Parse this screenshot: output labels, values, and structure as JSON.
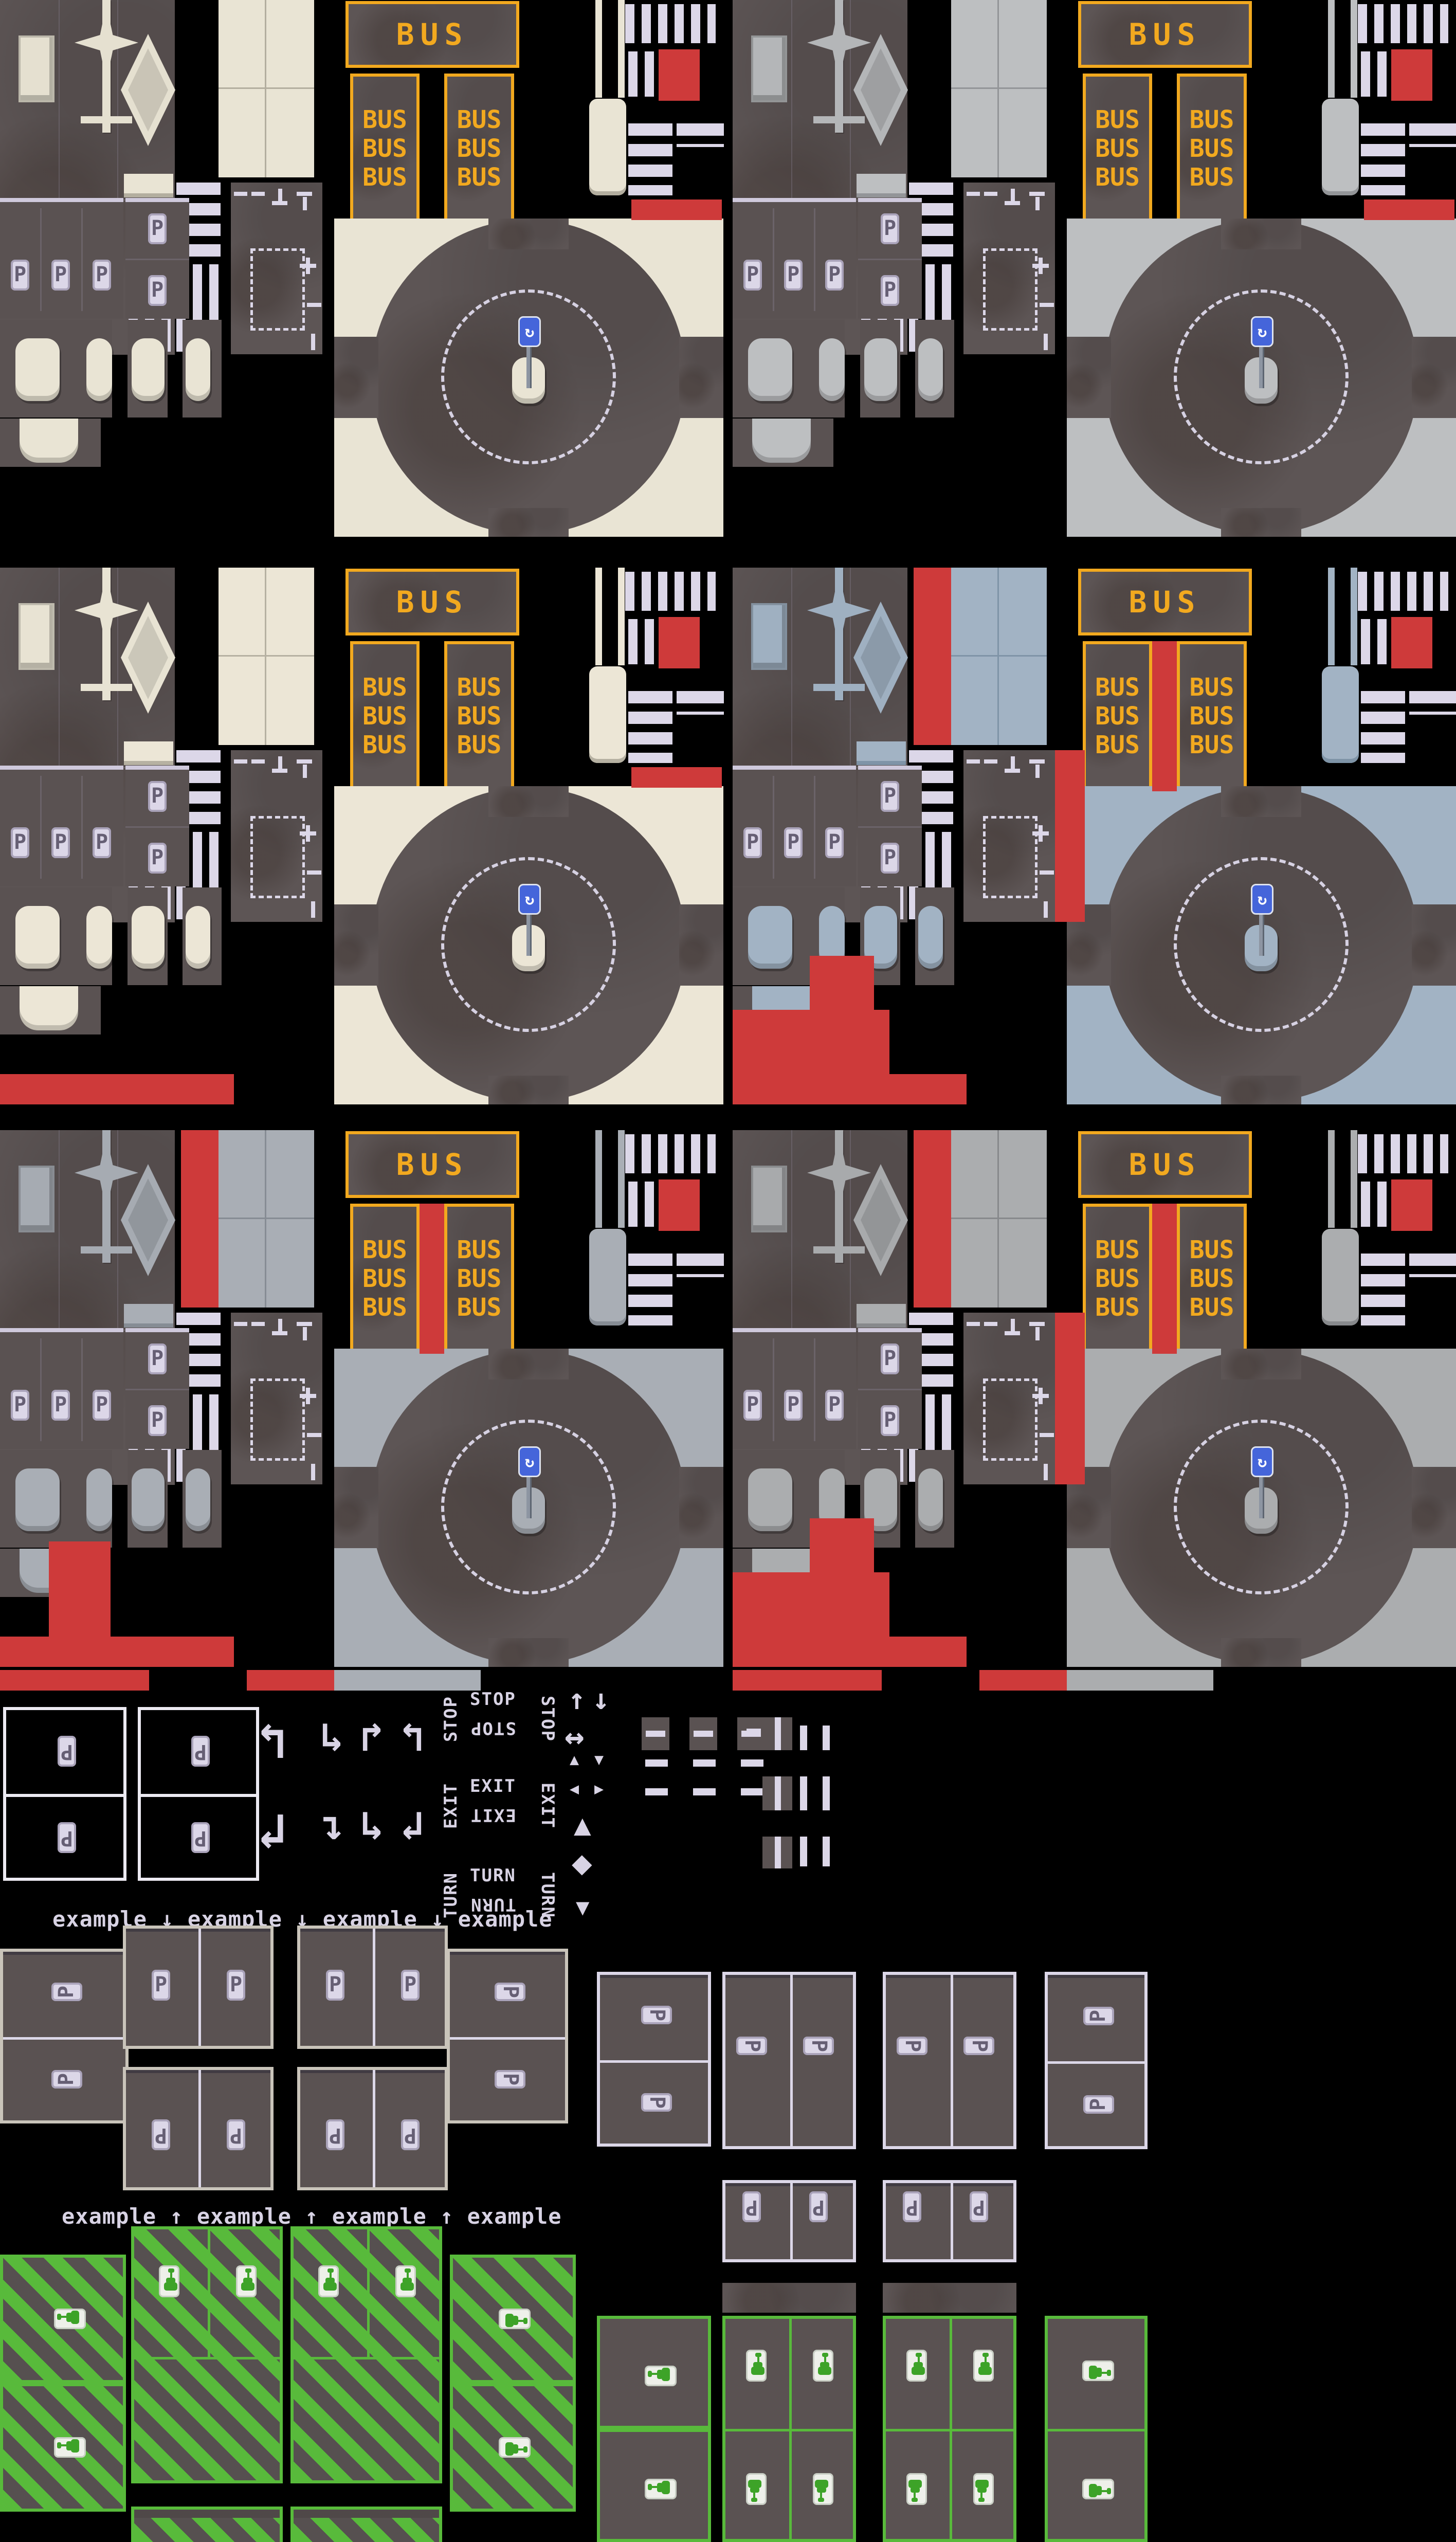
{
  "document": {
    "type": "game-tileset-spritesheet",
    "theme": "top-down city road tiles: bus stops, parking, crosswalks, roundabouts, EV charging stalls"
  },
  "labels": {
    "bus": "BUS",
    "parking_badge": "P",
    "stop": "STOP",
    "exit": "EXIT",
    "turn": "TURN",
    "example_row_down": "example ↓ example ↓ example ↓ example",
    "example_row_up": "example ↑ example ↑ example ↑ example",
    "roundabout_sign_glyph": "↻",
    "arrow_up": "↑",
    "arrow_down": "↓",
    "arrow_left_right": "↔",
    "arrow_up_left": "↰",
    "arrow_up_right": "↱",
    "arrow_down_left": "↲",
    "arrow_down_right": "↳",
    "arrow_right_down": "↴",
    "tri_up": "▲",
    "tri_down": "▼",
    "tri_left": "◀",
    "tri_right": "▶",
    "diamond": "◆"
  },
  "icons": [
    "roundabout-sign-icon",
    "ev-charging-car-icon",
    "parking-p-badge",
    "turn-arrow-icon",
    "yield-triangle-icon",
    "diamond-marking-icon"
  ],
  "colors": {
    "background": "#000000",
    "asphalt": "#5d5555",
    "asphalt_parking": "#5a5252",
    "road_line": "#dcd7e8",
    "bus_yellow": "#f2a91f",
    "red_placeholder": "#ce3a3a",
    "ev_green": "#58ba3b",
    "sign_blue": "#4565da",
    "badge_light": "#dcd7e8"
  },
  "sheets": [
    {
      "name": "cream-clean",
      "row": 0,
      "col": 0,
      "sidewalk": "#e9e4d4",
      "shadow": "#b3ae9f",
      "ornament": "#e5e0d0",
      "reds": [
        "rightTile",
        "rightStrip"
      ]
    },
    {
      "name": "gray-clean",
      "row": 0,
      "col": 1,
      "sidewalk": "#bdbfc1",
      "shadow": "#939598",
      "ornament": "#b4b6b8",
      "reds": [
        "rightTile",
        "rightStrip"
      ]
    },
    {
      "name": "cream-flagged",
      "row": 1,
      "col": 0,
      "sidewalk": "#ece6d6",
      "shadow": "#b6b1a2",
      "ornament": "#e8e3d3",
      "reds": [
        "rightTile",
        "rightStrip",
        "bottomStrip"
      ]
    },
    {
      "name": "bluegray-flagged",
      "row": 1,
      "col": 1,
      "sidewalk": "#a2b3c4",
      "shadow": "#7f94a7",
      "ornament": "#9fb0c1",
      "reds": [
        "leftColumn",
        "betweenLanes",
        "rightOfMarkings",
        "rightTile",
        "patchA",
        "patchB",
        "bottomStrip"
      ]
    },
    {
      "name": "steel-flagged",
      "row": 2,
      "col": 0,
      "sidewalk": "#a9aeb5",
      "shadow": "#868c94",
      "ornament": "#a6abb2",
      "reds": [
        "leftColumn",
        "betweenLanes",
        "rightTile",
        "islandPatch",
        "bottomStrip"
      ],
      "bottomSegments": true
    },
    {
      "name": "gray-flagged",
      "row": 2,
      "col": 1,
      "sidewalk": "#abadaf",
      "shadow": "#87898c",
      "ornament": "#a8aaac",
      "reds": [
        "leftColumn",
        "betweenLanes",
        "rightOfMarkings",
        "rightTile",
        "patchA",
        "patchB",
        "bottomStrip"
      ],
      "bottomSegments": true
    }
  ],
  "small_tiles": {
    "parking_box_count": 2,
    "hook_arrows": [
      "↰",
      "↲"
    ],
    "turn_arrows": [
      "↳",
      "↱",
      "↰",
      "↴",
      "↳",
      "↲"
    ],
    "word_clusters": [
      "STOP",
      "EXIT",
      "TURN"
    ],
    "marking_arrows": [
      "↑",
      "↓",
      "↔",
      "▲",
      "▼",
      "◀",
      "▶",
      "▲",
      "◆",
      "▼"
    ]
  },
  "example_section": {
    "caption_down": "example ↓ example ↓ example ↓ example",
    "caption_up": "example ↑ example ↑ example ↑ example",
    "stall_badge": "P"
  },
  "ev_section": {
    "style_left": "green-striped-stalls",
    "style_right": "green-outline-stalls",
    "icon": "ev-charging-car-icon"
  }
}
